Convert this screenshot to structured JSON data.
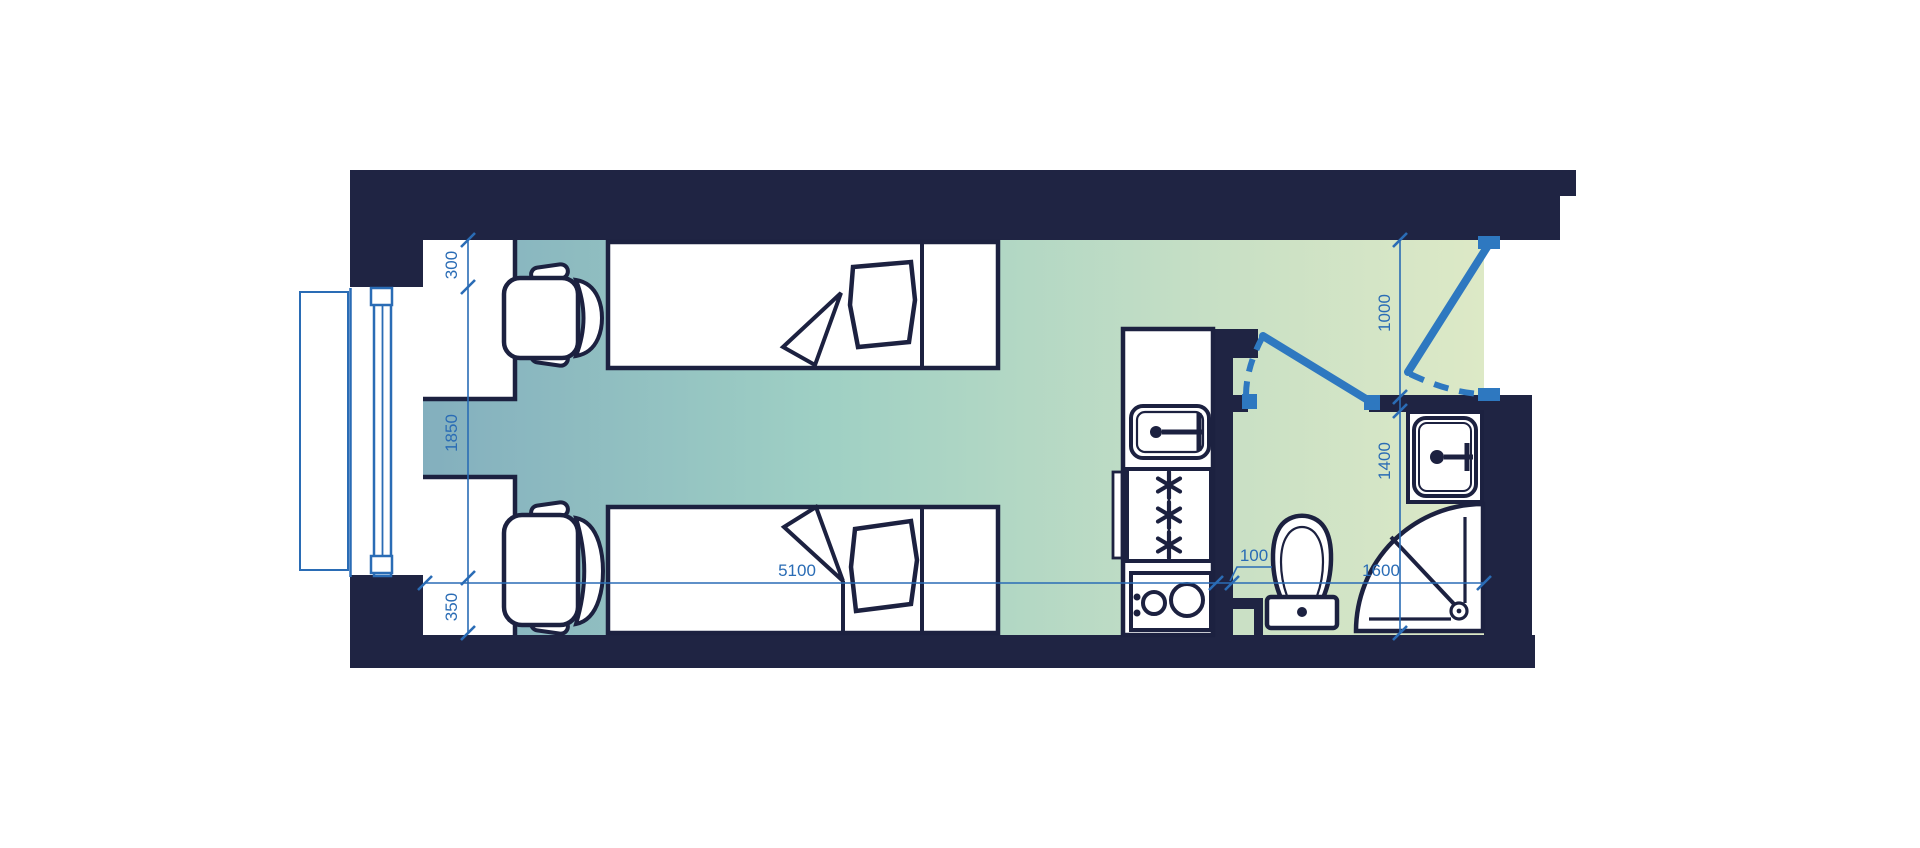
{
  "plan": {
    "type": "studio-apartment-floor-plan",
    "colors": {
      "wall": "#1f2443",
      "outline": "#1c2140",
      "dimension_blue": "#2a6cb5",
      "door_blue": "#2e78c0",
      "floor_gradient_start": "#7ea9bd",
      "floor_gradient_mid": "#9fd0c4",
      "floor_gradient_end": "#dde9c6"
    },
    "dimensions": {
      "desk_zone": "300",
      "window_span": "1850",
      "lower_pier": "350",
      "room_length": "5100",
      "partition": "100",
      "bathroom_length": "1600",
      "entry_opening": "1000",
      "bathroom_depth": "1400"
    },
    "furniture": [
      "desk",
      "office-chair",
      "single-bed",
      "desk",
      "office-chair",
      "single-bed",
      "kitchen-sink-counter",
      "fridge-freezer",
      "cooktop",
      "toilet",
      "washbasin",
      "quarter-circle-shower"
    ],
    "openings": [
      "window-left-wall",
      "entrance-door-top-right",
      "bathroom-door"
    ]
  }
}
